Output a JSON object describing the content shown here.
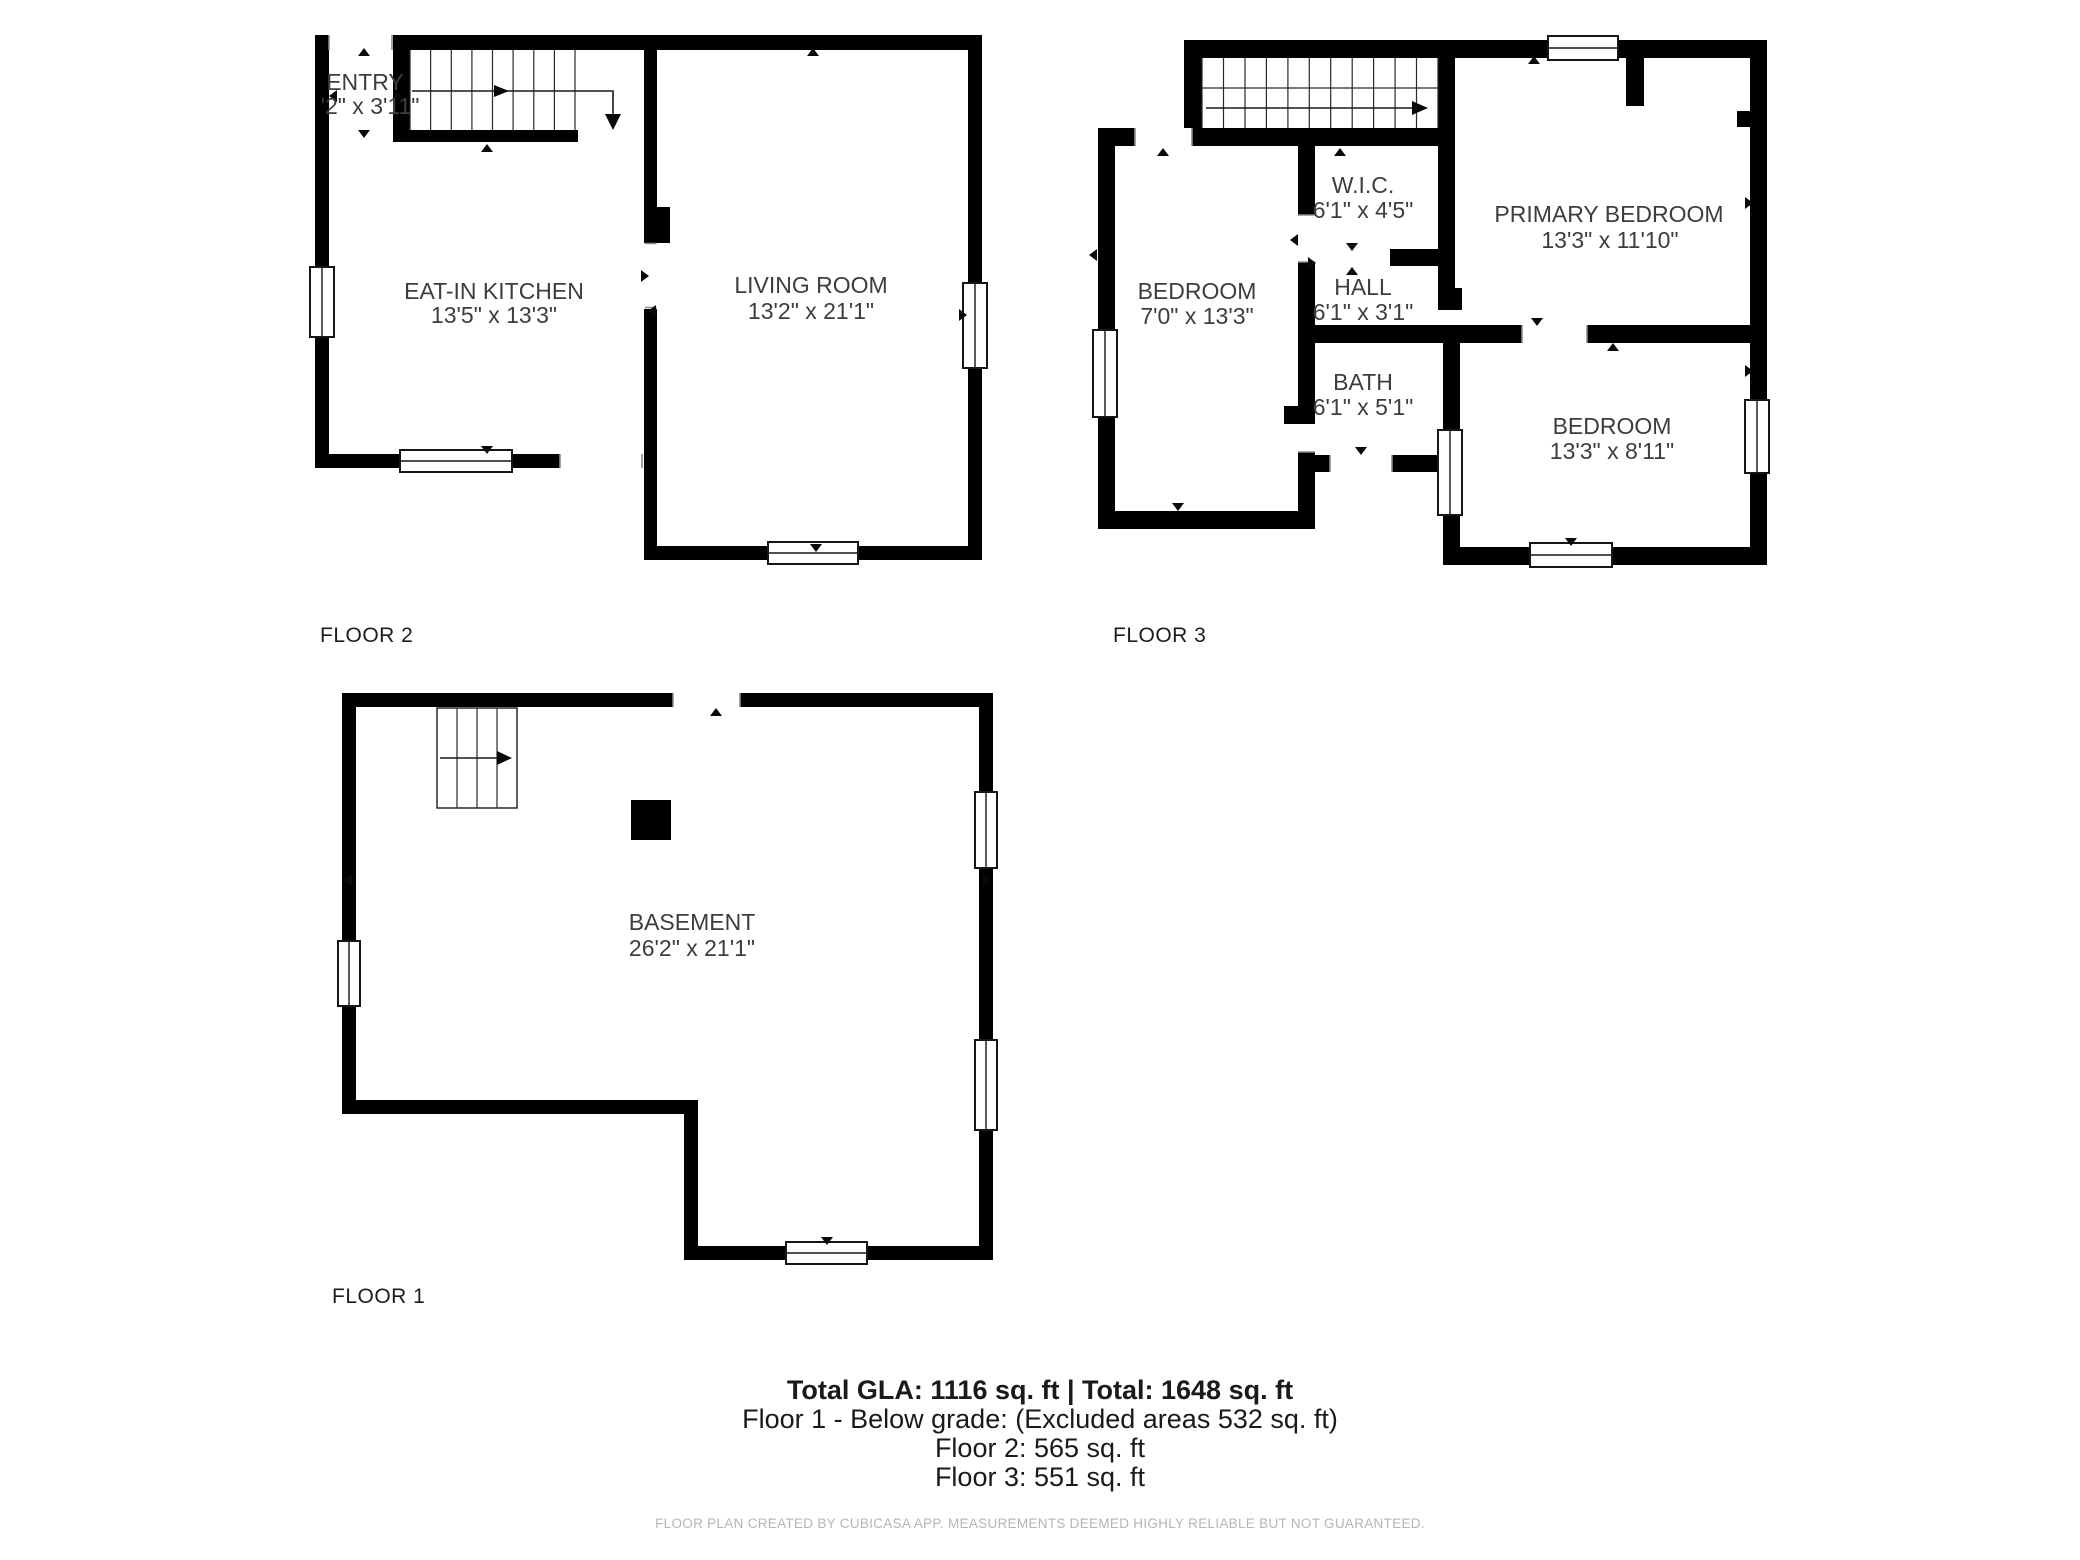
{
  "colors": {
    "wall": "#000000",
    "room_text": "#3d3d3d",
    "floor_label_text": "#1c1c1c",
    "footer_text": "#1a1a1a",
    "disclaimer_text": "#b5b5b5",
    "background": "#ffffff"
  },
  "floor2": {
    "label": "FLOOR 2",
    "rooms": {
      "entry": {
        "name": "ENTRY",
        "dims": "'2\" x 3'11\""
      },
      "kitchen": {
        "name": "EAT-IN KITCHEN",
        "dims": "13'5\" x 13'3\""
      },
      "living": {
        "name": "LIVING ROOM",
        "dims": "13'2\" x 21'1\""
      }
    }
  },
  "floor3": {
    "label": "FLOOR 3",
    "rooms": {
      "bedroom_left": {
        "name": "BEDROOM",
        "dims": "7'0\" x 13'3\""
      },
      "wic": {
        "name": "W.I.C.",
        "dims": "6'1\" x 4'5\""
      },
      "hall": {
        "name": "HALL",
        "dims": "6'1\" x 3'1\""
      },
      "bath": {
        "name": "BATH",
        "dims": "6'1\" x 5'1\""
      },
      "primary": {
        "name": "PRIMARY BEDROOM",
        "dims": "13'3\" x 11'10\""
      },
      "bedroom_right": {
        "name": "BEDROOM",
        "dims": "13'3\" x 8'11\""
      }
    }
  },
  "floor1": {
    "label": "FLOOR 1",
    "rooms": {
      "basement": {
        "name": "BASEMENT",
        "dims": "26'2\" x 21'1\""
      }
    }
  },
  "footer": {
    "totals_line": "Total GLA: 1116 sq. ft | Total: 1648 sq. ft",
    "floor1_line": "Floor 1 - Below grade: (Excluded areas 532 sq. ft)",
    "floor2_line": "Floor 2: 565 sq. ft",
    "floor3_line": "Floor 3: 551 sq. ft",
    "disclaimer": "FLOOR PLAN CREATED BY CUBICASA APP. MEASUREMENTS DEEMED HIGHLY RELIABLE BUT NOT GUARANTEED."
  }
}
